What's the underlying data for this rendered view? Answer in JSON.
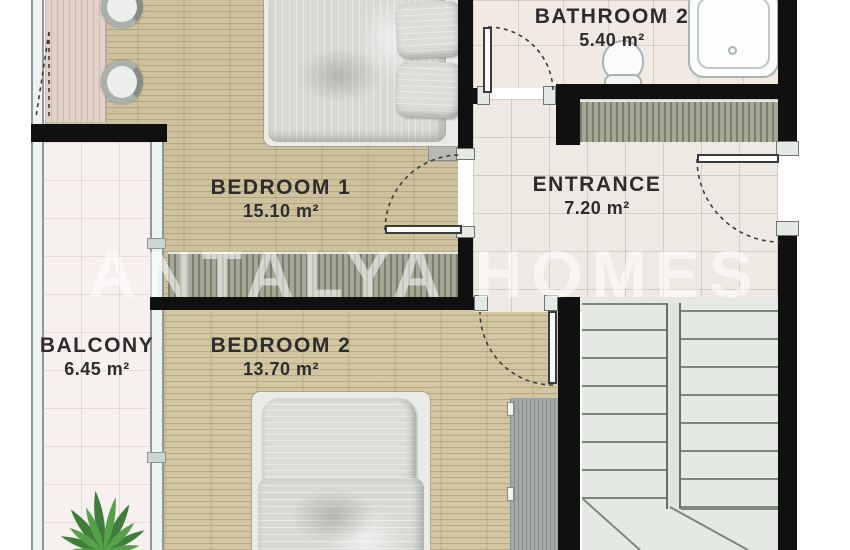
{
  "floorplan": {
    "watermark_text": "ANTALYA HOMES",
    "rooms": [
      {
        "id": "bathroom2",
        "name": "BATHROOM 2",
        "area": "5.40 m²"
      },
      {
        "id": "bedroom1",
        "name": "BEDROOM 1",
        "area": "15.10 m²"
      },
      {
        "id": "entrance",
        "name": "ENTRANCE",
        "area": "7.20 m²"
      },
      {
        "id": "balcony",
        "name": "BALCONY",
        "area": "6.45 m²"
      },
      {
        "id": "bedroom2",
        "name": "BEDROOM 2",
        "area": "13.70 m²"
      }
    ],
    "fixtures": [
      "double-bed-1",
      "double-bed-2",
      "bathtub",
      "toilet",
      "desk",
      "chairs",
      "wardrobes",
      "staircase",
      "plant",
      "doors",
      "balcony-glazing"
    ],
    "colors": {
      "wall": "#101010",
      "wood_floor": "#cec29e",
      "tile_floor": "#efe9e4",
      "stairs": "#e4e9e3",
      "wardrobe": "#a5a897",
      "label_text": "#2d2d2d",
      "watermark": "rgba(255,255,255,0.55)"
    }
  }
}
